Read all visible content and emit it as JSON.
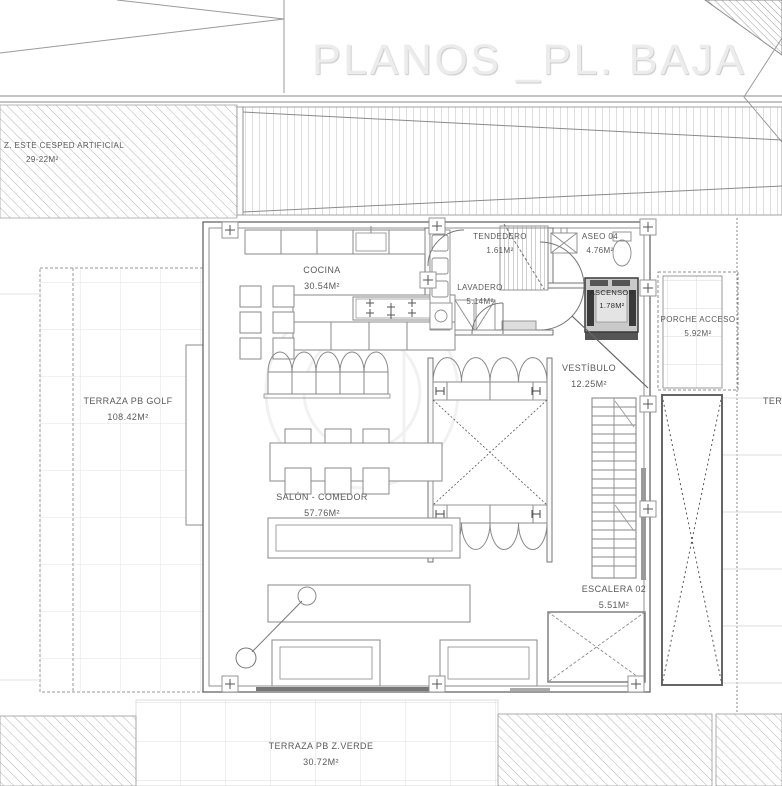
{
  "title": "PLANOS _PL. BAJA",
  "zones": {
    "cesped": {
      "label": "Z. ESTE CESPED ARTIFICIAL",
      "area": "29-22m²"
    },
    "terraza_golf": {
      "label": "TERRAZA PB GOLF",
      "area": "108.42m²"
    },
    "cocina": {
      "label": "COCINA",
      "area": "30.54m²"
    },
    "lavadero": {
      "label": "LAVADERO",
      "area": "5.14m²"
    },
    "tendedero": {
      "label": "TENDEDERO",
      "area": "1.61m²"
    },
    "aseo": {
      "label": "ASEO 04",
      "area": "4.76m²"
    },
    "ascensor": {
      "label": "ASCENSOR",
      "area": "1.78m²"
    },
    "vestibulo": {
      "label": "VESTÍBULO",
      "area": "12.25m²"
    },
    "porche": {
      "label": "PORCHE ACCESO",
      "area": "5.92m²"
    },
    "salon": {
      "label": "SALÓN - COMEDOR",
      "area": "57.76m²"
    },
    "escalera": {
      "label": "ESCALERA 02",
      "area": "5.51m²"
    },
    "terraza_verde": {
      "label": "TERRAZA PB Z.VERDE",
      "area": "30.72m²"
    },
    "terraza_right_partial": {
      "label": "TERRAZA"
    }
  },
  "colors": {
    "line_gray": "#8a8a8a",
    "wall_gray": "#666666",
    "text_gray": "#5a5a5a",
    "title_gray": "#ececec",
    "dark_fill": "#3a3a3a"
  }
}
